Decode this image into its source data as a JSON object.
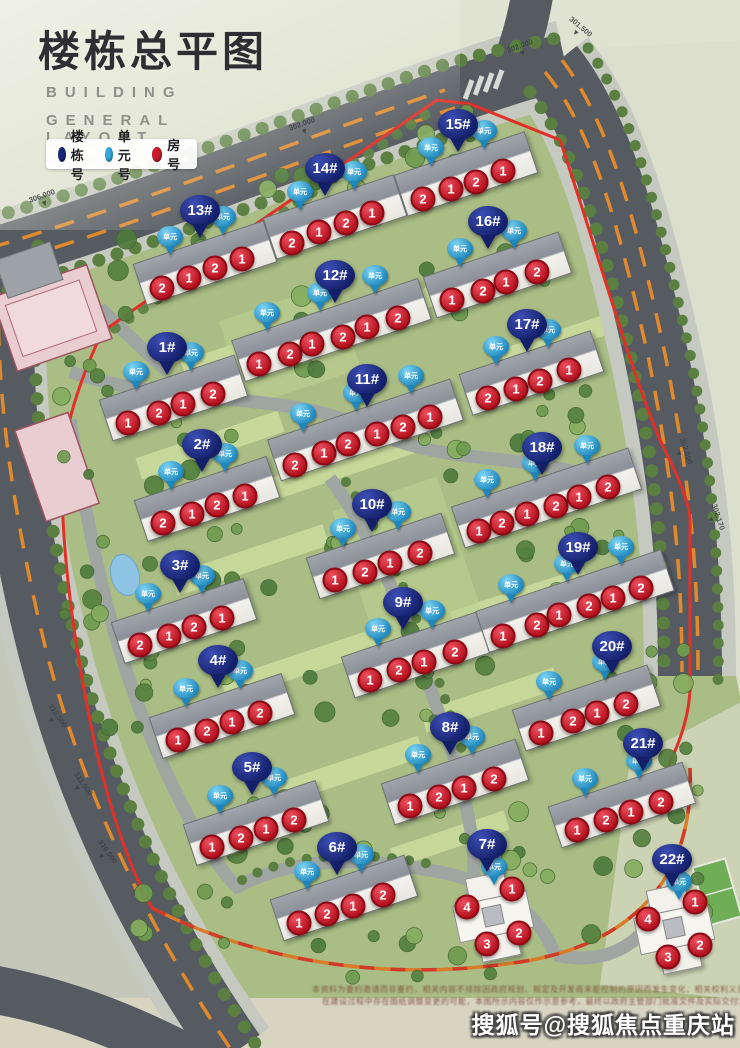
{
  "header": {
    "title_cn": "楼栋总平图",
    "subtitle_line1": "BUILDING",
    "subtitle_line2": "GENERAL LAYOUT"
  },
  "legend": {
    "items": [
      {
        "label": "楼栋号",
        "color": "#1b2878"
      },
      {
        "label": "单元号",
        "color": "#35a7dd"
      },
      {
        "label": "房号",
        "color": "#c81a2b"
      }
    ]
  },
  "map": {
    "unit_pin_label": "单元",
    "boundary_color": "#e23028",
    "road_dash_color": "#e08a2d",
    "buildings": [
      {
        "id": "1#",
        "pin": [
          167,
          375
        ],
        "rooms": [
          [
            1,
            128,
            423
          ],
          [
            2,
            159,
            413
          ],
          [
            1,
            183,
            404
          ],
          [
            2,
            213,
            394
          ]
        ]
      },
      {
        "id": "2#",
        "pin": [
          202,
          472
        ],
        "rooms": [
          [
            2,
            163,
            523
          ],
          [
            1,
            192,
            514
          ],
          [
            2,
            217,
            505
          ],
          [
            1,
            245,
            496
          ]
        ]
      },
      {
        "id": "3#",
        "pin": [
          180,
          593
        ],
        "rooms": [
          [
            2,
            140,
            645
          ],
          [
            1,
            169,
            636
          ],
          [
            2,
            194,
            627
          ],
          [
            1,
            222,
            618
          ]
        ]
      },
      {
        "id": "4#",
        "pin": [
          218,
          688
        ],
        "rooms": [
          [
            1,
            178,
            740
          ],
          [
            2,
            207,
            731
          ],
          [
            1,
            232,
            722
          ],
          [
            2,
            260,
            713
          ]
        ]
      },
      {
        "id": "5#",
        "pin": [
          252,
          795
        ],
        "rooms": [
          [
            1,
            212,
            847
          ],
          [
            2,
            241,
            838
          ],
          [
            1,
            266,
            829
          ],
          [
            2,
            294,
            820
          ]
        ]
      },
      {
        "id": "6#",
        "pin": [
          337,
          875
        ],
        "rooms": [
          [
            1,
            299,
            923
          ],
          [
            2,
            327,
            914
          ],
          [
            1,
            353,
            906
          ],
          [
            2,
            383,
            895
          ]
        ]
      },
      {
        "id": "7#",
        "pin": [
          487,
          872
        ],
        "type": "tower",
        "center": [
          492,
          916
        ],
        "rooms": [
          [
            1,
            512,
            889
          ],
          [
            4,
            467,
            907
          ],
          [
            2,
            519,
            933
          ],
          [
            3,
            487,
            944
          ]
        ]
      },
      {
        "id": "8#",
        "pin": [
          450,
          755
        ],
        "rooms": [
          [
            1,
            410,
            806
          ],
          [
            2,
            439,
            797
          ],
          [
            1,
            464,
            788
          ],
          [
            2,
            494,
            779
          ]
        ]
      },
      {
        "id": "9#",
        "pin": [
          403,
          630
        ],
        "rooms": [
          [
            1,
            370,
            680
          ],
          [
            2,
            399,
            670
          ],
          [
            1,
            424,
            662
          ],
          [
            2,
            455,
            652
          ]
        ]
      },
      {
        "id": "10#",
        "pin": [
          372,
          532
        ],
        "rooms": [
          [
            1,
            335,
            580
          ],
          [
            2,
            365,
            572
          ],
          [
            1,
            390,
            563
          ],
          [
            2,
            420,
            553
          ]
        ]
      },
      {
        "id": "11#",
        "pin": [
          367,
          407
        ],
        "rooms": [
          [
            2,
            295,
            465
          ],
          [
            1,
            324,
            453
          ],
          [
            2,
            348,
            444
          ],
          [
            1,
            377,
            434
          ],
          [
            2,
            403,
            427
          ],
          [
            1,
            430,
            417
          ]
        ]
      },
      {
        "id": "12#",
        "pin": [
          335,
          303
        ],
        "rooms": [
          [
            1,
            259,
            364
          ],
          [
            2,
            290,
            354
          ],
          [
            1,
            312,
            344
          ],
          [
            2,
            343,
            337
          ],
          [
            1,
            367,
            327
          ],
          [
            2,
            398,
            318
          ]
        ]
      },
      {
        "id": "13#",
        "pin": [
          200,
          238
        ],
        "rooms": [
          [
            2,
            162,
            288
          ],
          [
            1,
            189,
            278
          ],
          [
            2,
            215,
            268
          ],
          [
            1,
            242,
            259
          ]
        ]
      },
      {
        "id": "14#",
        "pin": [
          325,
          196
        ],
        "rooms": [
          [
            2,
            292,
            243
          ],
          [
            1,
            319,
            232
          ],
          [
            2,
            346,
            223
          ],
          [
            1,
            372,
            213
          ]
        ]
      },
      {
        "id": "15#",
        "pin": [
          458,
          152
        ],
        "rooms": [
          [
            2,
            423,
            199
          ],
          [
            1,
            451,
            189
          ],
          [
            2,
            476,
            182
          ],
          [
            1,
            503,
            171
          ]
        ]
      },
      {
        "id": "16#",
        "pin": [
          488,
          249
        ],
        "rooms": [
          [
            1,
            452,
            300
          ],
          [
            2,
            483,
            291
          ],
          [
            1,
            506,
            282
          ],
          [
            2,
            537,
            272
          ]
        ]
      },
      {
        "id": "17#",
        "pin": [
          527,
          352
        ],
        "rooms": [
          [
            2,
            488,
            398
          ],
          [
            1,
            516,
            389
          ],
          [
            2,
            540,
            381
          ],
          [
            1,
            569,
            370
          ]
        ]
      },
      {
        "id": "18#",
        "pin": [
          542,
          475
        ],
        "rooms": [
          [
            1,
            479,
            531
          ],
          [
            2,
            502,
            523
          ],
          [
            1,
            527,
            514
          ],
          [
            2,
            556,
            506
          ],
          [
            1,
            579,
            497
          ],
          [
            2,
            608,
            487
          ]
        ]
      },
      {
        "id": "19#",
        "pin": [
          578,
          575
        ],
        "rooms": [
          [
            1,
            503,
            636
          ],
          [
            2,
            537,
            625
          ],
          [
            1,
            559,
            615
          ],
          [
            2,
            589,
            606
          ],
          [
            1,
            613,
            598
          ],
          [
            2,
            641,
            588
          ]
        ]
      },
      {
        "id": "20#",
        "pin": [
          612,
          674
        ],
        "rooms": [
          [
            1,
            541,
            733
          ],
          [
            2,
            573,
            721
          ],
          [
            1,
            597,
            713
          ],
          [
            2,
            626,
            704
          ]
        ]
      },
      {
        "id": "21#",
        "pin": [
          643,
          771
        ],
        "rooms": [
          [
            1,
            577,
            830
          ],
          [
            2,
            606,
            820
          ],
          [
            1,
            631,
            812
          ],
          [
            2,
            661,
            802
          ]
        ]
      },
      {
        "id": "22#",
        "pin": [
          672,
          887
        ],
        "type": "tower",
        "center": [
          673,
          928
        ],
        "rooms": [
          [
            1,
            695,
            902
          ],
          [
            4,
            648,
            919
          ],
          [
            2,
            700,
            945
          ],
          [
            3,
            668,
            957
          ]
        ]
      }
    ],
    "elevation_labels": [
      {
        "t": "301.500",
        "x": 564,
        "y": 22,
        "r": 40
      },
      {
        "t": "302.000",
        "x": 508,
        "y": 42,
        "r": -20
      },
      {
        "t": "302.000",
        "x": 290,
        "y": 120,
        "r": -20
      },
      {
        "t": "306.000",
        "x": 30,
        "y": 192,
        "r": -20
      },
      {
        "t": "302.000",
        "x": 668,
        "y": 444,
        "r": 72
      },
      {
        "t": "302.170",
        "x": 700,
        "y": 510,
        "r": 72
      },
      {
        "t": "312.500",
        "x": 40,
        "y": 710,
        "r": 55
      },
      {
        "t": "311.500",
        "x": 66,
        "y": 778,
        "r": 55
      },
      {
        "t": "316.000",
        "x": 90,
        "y": 846,
        "r": 55
      }
    ]
  },
  "footer": {
    "disclaimer_line1": "本资料为要约邀请而非要约，相关内容不排除因政府规划、规定及开发商未能控制的原因而发生变化，相关权利义务以双方签订的商品房买卖合同及附件等协议为准。",
    "disclaimer_line2": "在建设过程中存在图纸调整变更的可能，本图所示内容仅作示意参考，最终以政府主管部门批准文件及实际交付为准，不构成任何承诺。",
    "watermark": "搜狐号@搜狐焦点重庆站"
  }
}
